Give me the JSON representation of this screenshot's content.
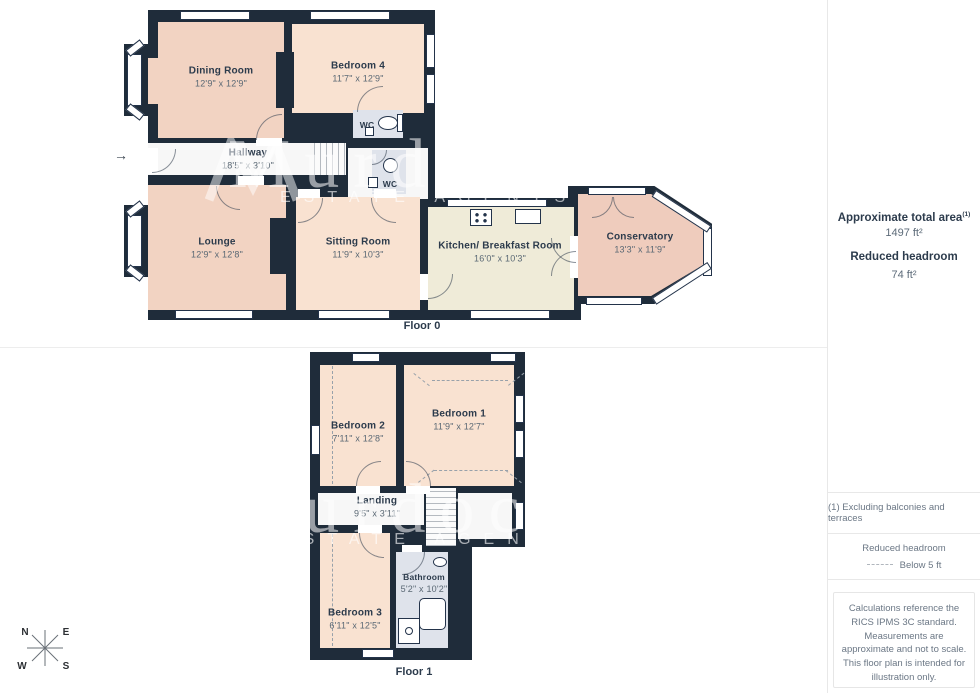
{
  "watermark": {
    "brand": "Murdoch",
    "subtitle": "ESTATE AGENTS"
  },
  "floor0": {
    "label": "Floor 0",
    "rooms": {
      "dining": {
        "name": "Dining Room",
        "dims": "12'9\" x 12'9\""
      },
      "bedroom4": {
        "name": "Bedroom 4",
        "dims": "11'7\" x 12'9\""
      },
      "wc1": {
        "name": "WC"
      },
      "wc2": {
        "name": "WC"
      },
      "hallway": {
        "name": "Hallway",
        "dims": "18'5\" x 3'10\""
      },
      "lounge": {
        "name": "Lounge",
        "dims": "12'9\" x 12'8\""
      },
      "sitting": {
        "name": "Sitting Room",
        "dims": "11'9\" x 10'3\""
      },
      "kitchen": {
        "name": "Kitchen/ Breakfast Room",
        "dims": "16'0\" x 10'3\""
      },
      "conservatory": {
        "name": "Conservatory",
        "dims": "13'3\" x 11'9\""
      }
    }
  },
  "floor1": {
    "label": "Floor 1",
    "rooms": {
      "bedroom2": {
        "name": "Bedroom 2",
        "dims": "7'11\" x 12'8\""
      },
      "bedroom1": {
        "name": "Bedroom 1",
        "dims": "11'9\" x 12'7\""
      },
      "landing": {
        "name": "Landing",
        "dims": "9'5\" x 3'11\""
      },
      "bathroom": {
        "name": "Bathroom",
        "dims": "5'2\" x 10'2\""
      },
      "bedroom3": {
        "name": "Bedroom 3",
        "dims": "6'11\" x 12'5\""
      }
    }
  },
  "sidebar": {
    "total_area_label": "Approximate total area",
    "total_area_superscript": "(1)",
    "total_area_value": "1497 ft²",
    "reduced_headroom_label": "Reduced headroom",
    "reduced_headroom_value": "74 ft²",
    "footnote": "(1) Excluding balconies and terraces",
    "legend_label": "Reduced headroom",
    "legend_value": "Below 5 ft",
    "disclaimer": "Calculations reference the RICS IPMS 3C standard. Measurements are approximate and not to scale. This floor plan is intended for illustration only.",
    "brand_name": "GIRAFFE",
    "brand_number": "360"
  },
  "compass": {
    "n": "N",
    "e": "E",
    "s": "S",
    "w": "W"
  }
}
